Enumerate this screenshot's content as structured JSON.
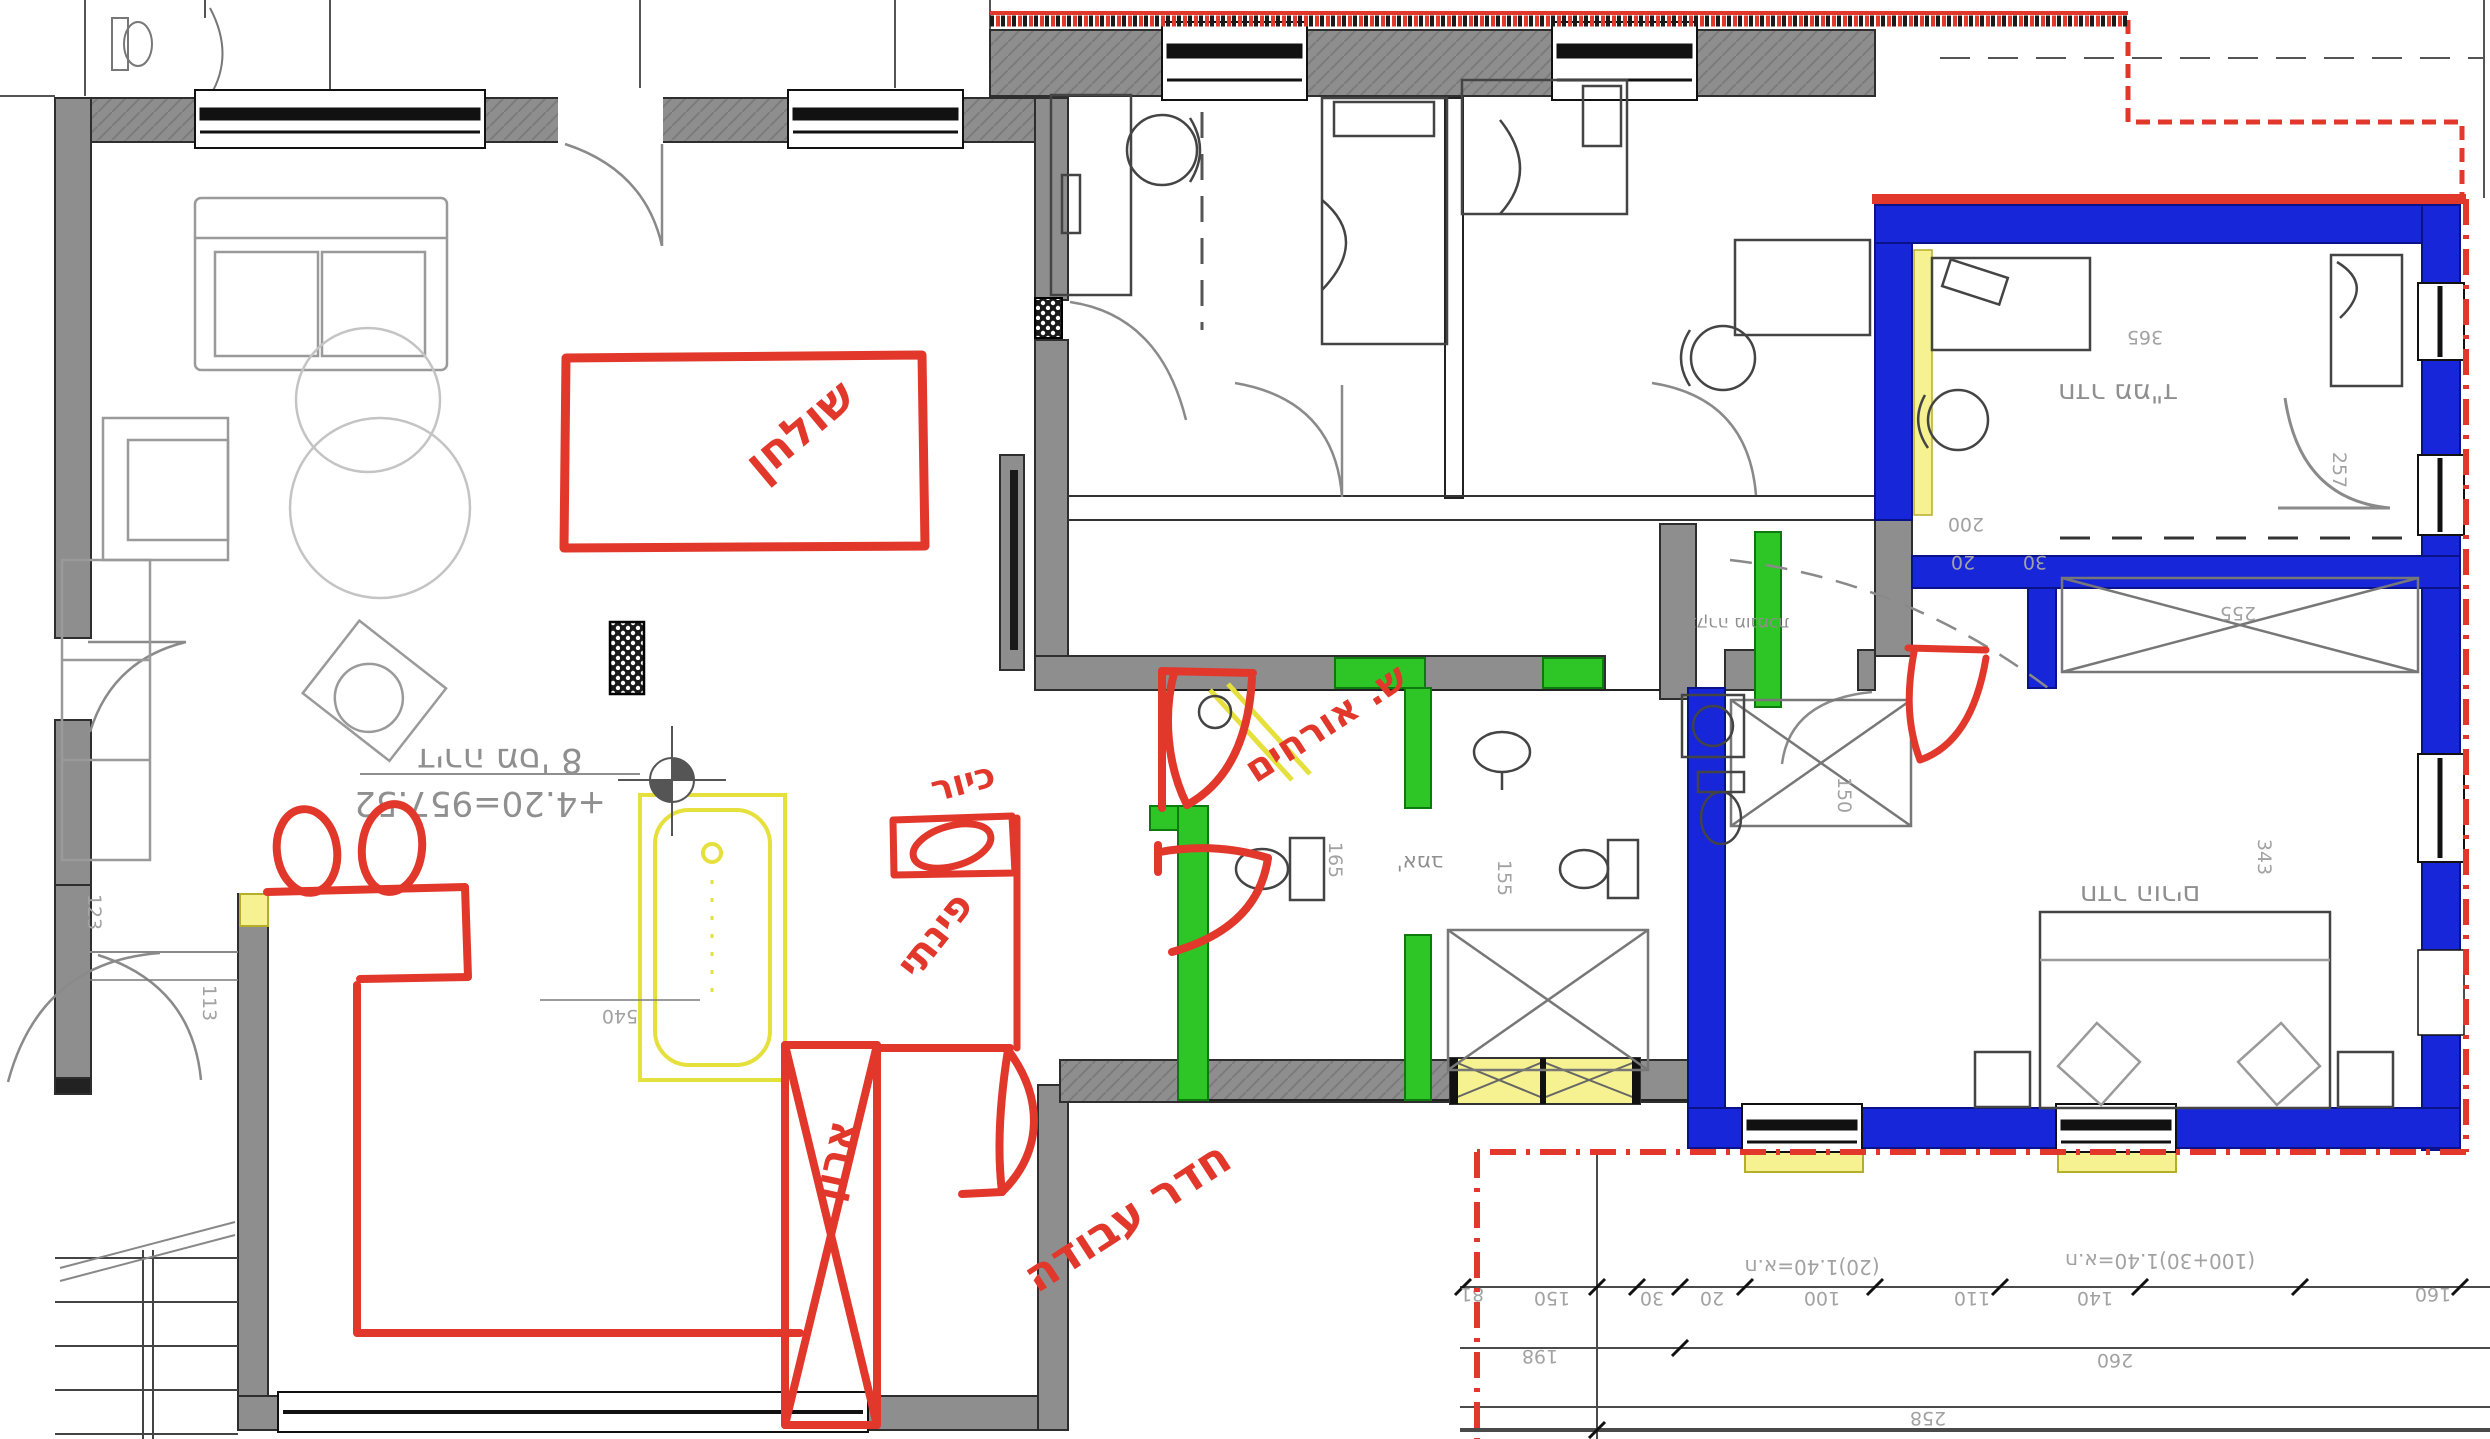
{
  "markup": {
    "table": "שולחן",
    "sink": "כיור",
    "sink_style": "פינתי",
    "guest_bath": "ש. אורחים",
    "closet": "ארון",
    "work_room": "חדר עבודה"
  },
  "plan_text": {
    "apartment": "דירה מס' 8",
    "elevation": "+4.20=957.52",
    "room_mamad": "חדר ממ\"ד",
    "room_parents": "חדר הורים",
    "note_ceiling": "תקרה מונמכת",
    "bath": "אמב'",
    "win_note_a": "ח.א=1.40(20)",
    "win_note_b": "ח.א=1.40(100+30)"
  },
  "dims": {
    "d113": "113",
    "d123": "123",
    "d540": "540",
    "d365": "365",
    "d257": "257",
    "d343": "343",
    "d255": "255",
    "d200": "200",
    "d30a": "30",
    "d20a": "20",
    "d150a": "150",
    "d165": "165",
    "d155": "155",
    "d81": "81",
    "d150": "150",
    "d30": "30",
    "d20": "20",
    "d100": "100",
    "d110": "110",
    "d140": "140",
    "d160": "160",
    "d198": "198",
    "d260": "260",
    "d258": "258"
  },
  "colors": {
    "wall_gray": "#8e8e8e",
    "safe_room_blue": "#1626d8",
    "new_wall_green": "#2ec527",
    "highlight_yellow": "#f6f291",
    "markup_red": "#e2372b",
    "cad_text_gray": "#8f8f8f"
  }
}
